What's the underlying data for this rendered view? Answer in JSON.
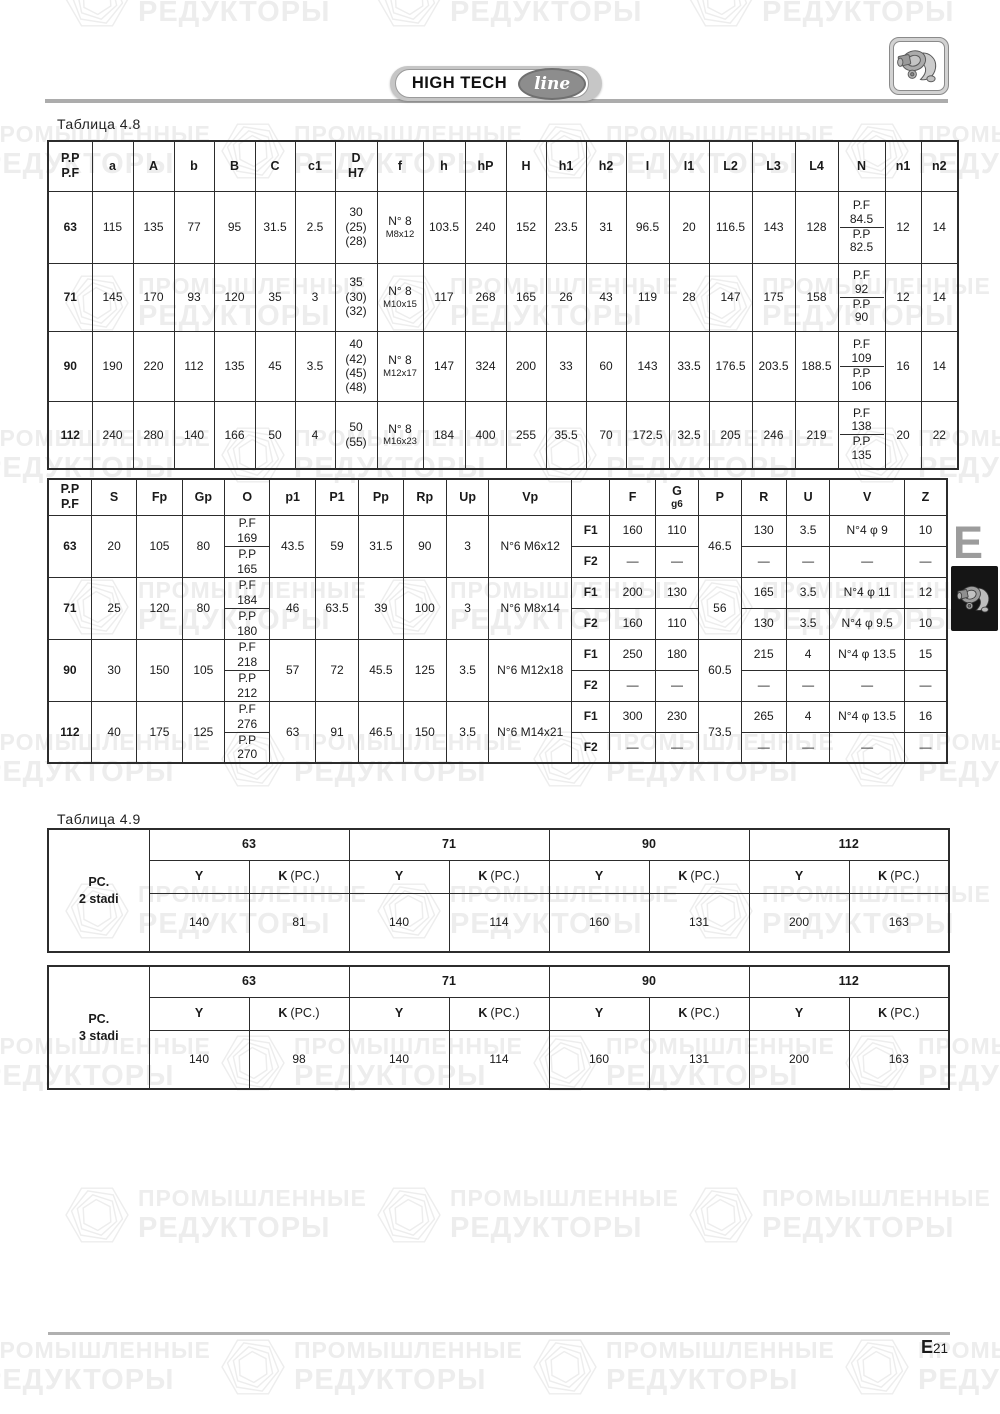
{
  "header": {
    "title": "HIGH TECH",
    "script": "line"
  },
  "watermark": {
    "line1": "ПРОМЫШЛЕННЫЕ",
    "line2": "РЕДУКТОРЫ"
  },
  "tab": {
    "letter": "E"
  },
  "footer": {
    "page_letter": "E",
    "page_number": "21"
  },
  "table48": {
    "caption": "Таблица 4.8",
    "dim": {
      "headers": [
        "P.P\nP.F",
        "a",
        "A",
        "b",
        "B",
        "C",
        "c1",
        "D\nH7",
        "f",
        "h",
        "hP",
        "H",
        "h1",
        "h2",
        "I",
        "I1",
        "L2",
        "L3",
        "L4",
        "N",
        "n1",
        "n2"
      ],
      "rows": [
        {
          "size": "63",
          "a": "115",
          "A": "135",
          "b": "77",
          "B": "95",
          "C": "31.5",
          "c1": "2.5",
          "D": "30\n(25)\n(28)",
          "f_top": "N° 8",
          "f_sub": "M8x12",
          "h": "103.5",
          "hP": "240",
          "H": "152",
          "h1": "23.5",
          "h2": "31",
          "I": "96.5",
          "I1": "20",
          "L2": "116.5",
          "L3": "143",
          "L4": "128",
          "N_pf": "P.F\n84.5",
          "N_pp": "P.P\n82.5",
          "n1": "12",
          "n2": "14"
        },
        {
          "size": "71",
          "a": "145",
          "A": "170",
          "b": "93",
          "B": "120",
          "C": "35",
          "c1": "3",
          "D": "35\n(30)\n(32)",
          "f_top": "N° 8",
          "f_sub": "M10x15",
          "h": "117",
          "hP": "268",
          "H": "165",
          "h1": "26",
          "h2": "43",
          "I": "119",
          "I1": "28",
          "L2": "147",
          "L3": "175",
          "L4": "158",
          "N_pf": "P.F\n92",
          "N_pp": "P.P\n90",
          "n1": "12",
          "n2": "14"
        },
        {
          "size": "90",
          "a": "190",
          "A": "220",
          "b": "112",
          "B": "135",
          "C": "45",
          "c1": "3.5",
          "D": "40\n(42)\n(45)\n(48)",
          "f_top": "N° 8",
          "f_sub": "M12x17",
          "h": "147",
          "hP": "324",
          "H": "200",
          "h1": "33",
          "h2": "60",
          "I": "143",
          "I1": "33.5",
          "L2": "176.5",
          "L3": "203.5",
          "L4": "188.5",
          "N_pf": "P.F\n109",
          "N_pp": "P.P\n106",
          "n1": "16",
          "n2": "14"
        },
        {
          "size": "112",
          "a": "240",
          "A": "280",
          "b": "140",
          "B": "166",
          "C": "50",
          "c1": "4",
          "D": "50\n(55)",
          "f_top": "N° 8",
          "f_sub": "M16x23",
          "h": "184",
          "hP": "400",
          "H": "255",
          "h1": "35.5",
          "h2": "70",
          "I": "172.5",
          "I1": "32.5",
          "L2": "205",
          "L3": "246",
          "L4": "219",
          "N_pf": "P.F\n138",
          "N_pp": "P.P\n135",
          "n1": "20",
          "n2": "22"
        }
      ]
    },
    "mount": {
      "headers": [
        "P.P\nP.F",
        "S",
        "Fp",
        "Gp",
        "O",
        "p1",
        "P1",
        "Pp",
        "Rp",
        "Up",
        "Vp",
        "",
        "F",
        "G",
        "g6",
        "P",
        "R",
        "U",
        "V",
        "Z"
      ],
      "rows": [
        {
          "size": "63",
          "S": "20",
          "Fp": "105",
          "Gp": "80",
          "O_pf": "P.F\n169",
          "O_pp": "P.P\n165",
          "p1": "43.5",
          "P1": "59",
          "Pp": "31.5",
          "Rp": "90",
          "Up": "3",
          "Vp": "N°6 M6x12",
          "P": "46.5",
          "f1": {
            "label": "F1",
            "F": "160",
            "G": "110",
            "R": "130",
            "U": "3.5",
            "V": "N°4 φ 9",
            "Z": "10"
          },
          "f2": {
            "label": "F2",
            "F": "—",
            "G": "—",
            "R": "—",
            "U": "—",
            "V": "—",
            "Z": "—"
          }
        },
        {
          "size": "71",
          "S": "25",
          "Fp": "120",
          "Gp": "80",
          "O_pf": "P.F\n184",
          "O_pp": "P.P\n180",
          "p1": "46",
          "P1": "63.5",
          "Pp": "39",
          "Rp": "100",
          "Up": "3",
          "Vp": "N°6 M8x14",
          "P": "56",
          "f1": {
            "label": "F1",
            "F": "200",
            "G": "130",
            "R": "165",
            "U": "3.5",
            "V": "N°4 φ 11",
            "Z": "12"
          },
          "f2": {
            "label": "F2",
            "F": "160",
            "G": "110",
            "R": "130",
            "U": "3.5",
            "V": "N°4 φ 9.5",
            "Z": "10"
          }
        },
        {
          "size": "90",
          "S": "30",
          "Fp": "150",
          "Gp": "105",
          "O_pf": "P.F\n218",
          "O_pp": "P.P\n212",
          "p1": "57",
          "P1": "72",
          "Pp": "45.5",
          "Rp": "125",
          "Up": "3.5",
          "Vp": "N°6 M12x18",
          "P": "60.5",
          "f1": {
            "label": "F1",
            "F": "250",
            "G": "180",
            "R": "215",
            "U": "4",
            "V": "N°4 φ 13.5",
            "Z": "15"
          },
          "f2": {
            "label": "F2",
            "F": "—",
            "G": "—",
            "R": "—",
            "U": "—",
            "V": "—",
            "Z": "—"
          }
        },
        {
          "size": "112",
          "S": "40",
          "Fp": "175",
          "Gp": "125",
          "O_pf": "P.F\n276",
          "O_pp": "P.P\n270",
          "p1": "63",
          "P1": "91",
          "Pp": "46.5",
          "Rp": "150",
          "Up": "3.5",
          "Vp": "N°6 M14x21",
          "P": "73.5",
          "f1": {
            "label": "F1",
            "F": "300",
            "G": "230",
            "R": "265",
            "U": "4",
            "V": "N°4 φ 13.5",
            "Z": "16"
          },
          "f2": {
            "label": "F2",
            "F": "—",
            "G": "—",
            "R": "—",
            "U": "—",
            "V": "—",
            "Z": "—"
          }
        }
      ]
    }
  },
  "table49": {
    "caption": "Таблица 4.9",
    "sizes": [
      "63",
      "71",
      "90",
      "112"
    ],
    "sub_y": "Y",
    "sub_k_b": "K",
    "sub_k_r": "(PC.)",
    "blocks": [
      {
        "label_top": "PC.",
        "label_bottom": "2 stadi",
        "values": [
          "140",
          "81",
          "140",
          "114",
          "160",
          "131",
          "200",
          "163"
        ]
      },
      {
        "label_top": "PC.",
        "label_bottom": "3 stadi",
        "values": [
          "140",
          "98",
          "140",
          "114",
          "160",
          "131",
          "200",
          "163"
        ]
      }
    ]
  }
}
